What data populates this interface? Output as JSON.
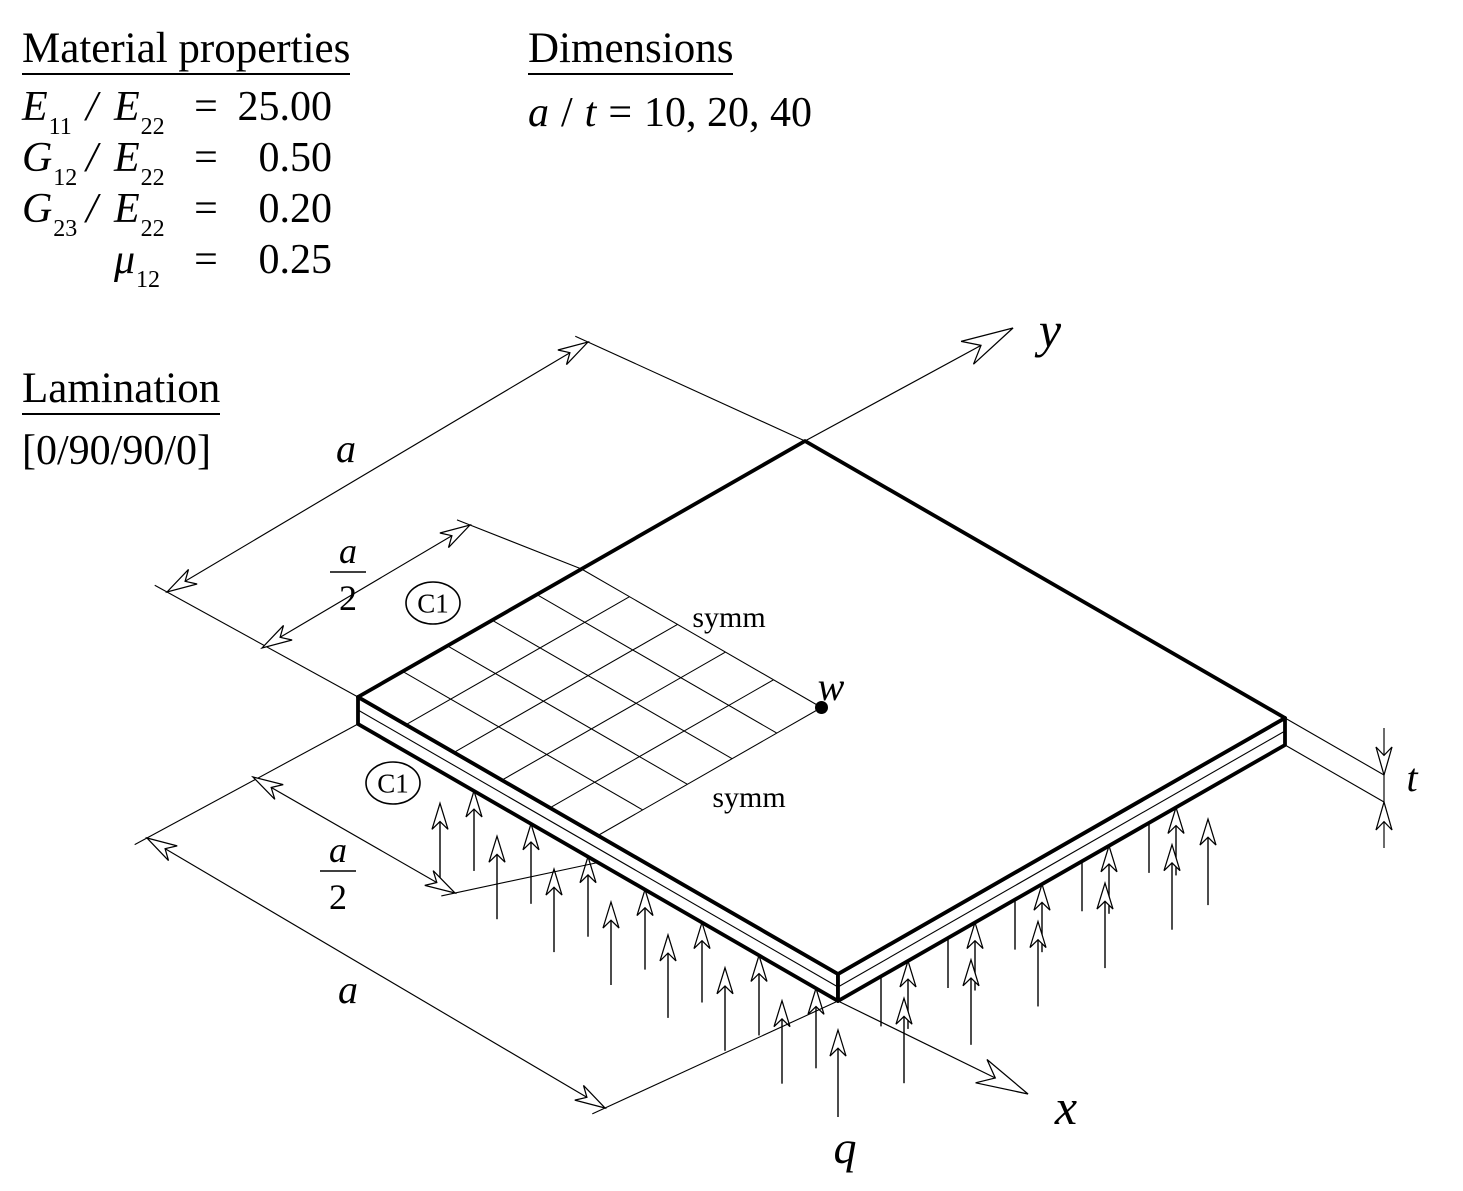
{
  "material_properties": {
    "title": "Material properties",
    "rows": [
      {
        "lhs": "E",
        "lhs_sub": "11",
        "slash": "/",
        "rhs": "E",
        "rhs_sub": "22",
        "eq": "=",
        "value": "25.00"
      },
      {
        "lhs": "G",
        "lhs_sub": "12",
        "slash": "/",
        "rhs": "E",
        "rhs_sub": "22",
        "eq": "=",
        "value": "0.50"
      },
      {
        "lhs": "G",
        "lhs_sub": "23",
        "slash": "/",
        "rhs": "E",
        "rhs_sub": "22",
        "eq": "=",
        "value": "0.20"
      },
      {
        "lhs": "",
        "lhs_sub": "",
        "slash": "",
        "rhs": "μ",
        "rhs_sub": "12",
        "eq": "=",
        "value": "0.25"
      }
    ]
  },
  "dimensions": {
    "title": "Dimensions",
    "formula": {
      "lhs": "a",
      "slash": "/",
      "rhs": "t",
      "eq": "=",
      "values": "10, 20, 40"
    }
  },
  "lamination": {
    "title": "Lamination",
    "layup": "[0/90/90/0]"
  },
  "figure": {
    "axis_labels": {
      "x": "x",
      "y": "y"
    },
    "load_label": "q",
    "deflection_label": "w",
    "thickness_label": "t",
    "symmetry_labels": [
      "symm",
      "symm"
    ],
    "boundary_condition_labels": [
      "C1",
      "C1"
    ],
    "dimension_labels": {
      "edge_full": "a",
      "edge_half_numerator": "a",
      "edge_half_denominator": "2"
    },
    "mesh": {
      "rows": 5,
      "cols": 5
    },
    "colors": {
      "ink": "#000000",
      "background": "#ffffff"
    }
  }
}
